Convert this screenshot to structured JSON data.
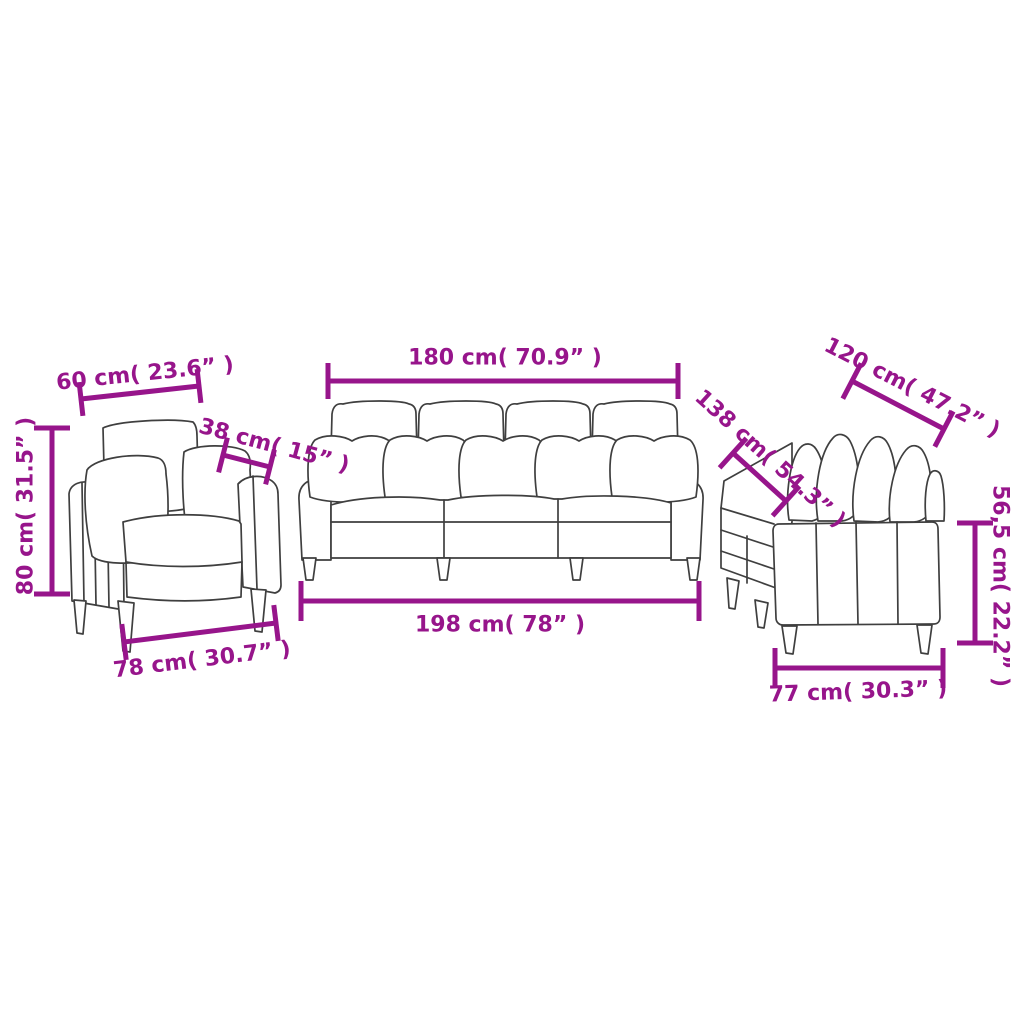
{
  "figure": {
    "description_text": "",
    "background_color": "#ffffff"
  },
  "colors": {
    "dimension_accent": "#97158b",
    "line_art": "#3f3f3f"
  },
  "dimensions": {
    "armchair": {
      "top": "60 cm( 23.6” )",
      "diagonal": "38 cm( 15” )",
      "left": "80 cm( 31.5” )",
      "bottom": "78 cm( 30.7” )"
    },
    "three_seater": {
      "top": "180 cm( 70.9” )",
      "bottom": "198 cm( 78” )"
    },
    "two_seater": {
      "top": "120 cm( 47.2” )",
      "diagonal": "138 cm( 54.3” )",
      "right": "56,5 cm( 22.2” )",
      "bottom": "77 cm( 30.3” )"
    }
  }
}
